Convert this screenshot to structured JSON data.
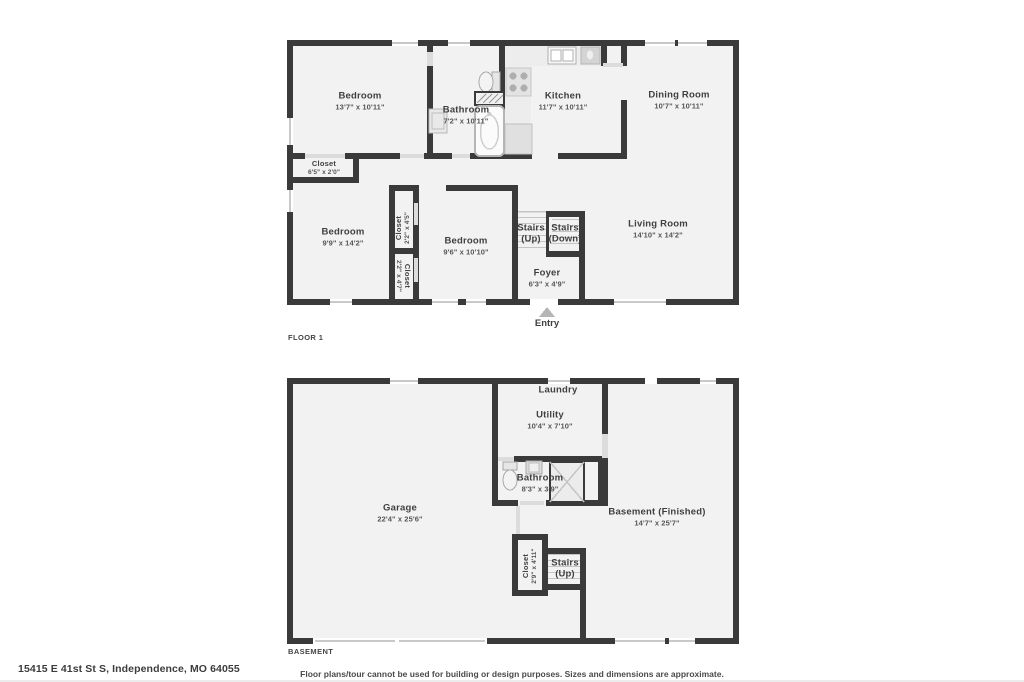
{
  "meta": {
    "address": "15415 E 41st St S, Independence, MO 64055",
    "disclaimer": "Floor plans/tour cannot be used for building or design purposes. Sizes and dimensions are approximate."
  },
  "floor1": {
    "title": "FLOOR 1",
    "entry": "Entry",
    "rooms": [
      {
        "name": "Bedroom",
        "dims": "13'7\" x 10'11\""
      },
      {
        "name": "Bathroom",
        "dims": "7'2\" x 10'11\""
      },
      {
        "name": "Kitchen",
        "dims": "11'7\" x 10'11\""
      },
      {
        "name": "Dining Room",
        "dims": "10'7\" x 10'11\""
      },
      {
        "name": "Closet",
        "dims": "6'5\" x 2'0\""
      },
      {
        "name": "Bedroom",
        "dims": "9'9\" x 14'2\""
      },
      {
        "name": "Closet",
        "dims": "2'2\" x 4'5\""
      },
      {
        "name": "Bedroom",
        "dims": "9'6\" x 10'10\""
      },
      {
        "name": "Closet",
        "dims": "2'2\" x 4'7\""
      },
      {
        "name": "Stairs",
        "dims": "(Up)"
      },
      {
        "name": "Stairs",
        "dims": "(Down)"
      },
      {
        "name": "Foyer",
        "dims": "6'3\" x 4'9\""
      },
      {
        "name": "Living Room",
        "dims": "14'10\" x 14'2\""
      }
    ]
  },
  "basement": {
    "title": "BASEMENT",
    "rooms": [
      {
        "name": "Laundry",
        "dims": ""
      },
      {
        "name": "Utility",
        "dims": "10'4\" x 7'10\""
      },
      {
        "name": "Bathroom",
        "dims": "8'3\" x 3'9\""
      },
      {
        "name": "Garage",
        "dims": "22'4\" x 25'6\""
      },
      {
        "name": "Basement (Finished)",
        "dims": "14'7\" x 25'7\""
      },
      {
        "name": "Closet",
        "dims": "2'9\" x 4'11\""
      },
      {
        "name": "Stairs",
        "dims": "(Up)"
      }
    ]
  },
  "colors": {
    "wall": "#3a3a3a",
    "floor": "#f2f2f2",
    "door": "#dcdcdc",
    "window_line": "#c9c9c9",
    "entry_arrow": "#b5b5b5"
  }
}
